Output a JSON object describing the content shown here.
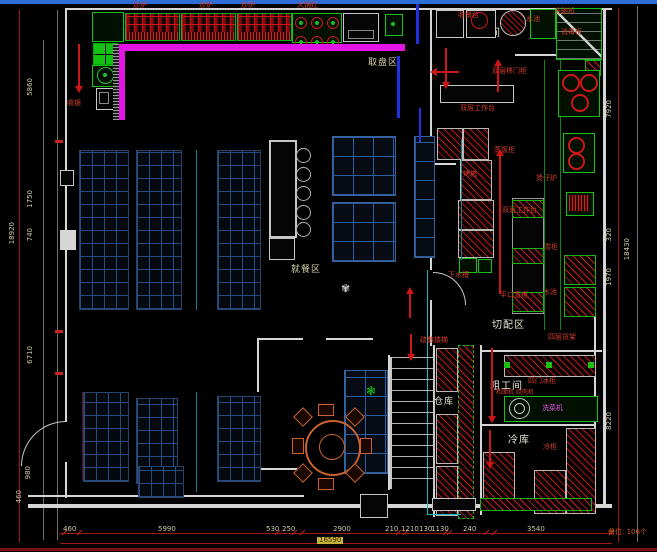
{
  "titlebar": {
    "color": "#2f6ed9"
  },
  "room_labels": {
    "dishwash": "洗碗间",
    "plate_area": "取盘区",
    "dining": "就餐区",
    "cutting": "切配区",
    "rough_work": "粗工间",
    "cold_storage": "冷库",
    "warehouse": "仓库"
  },
  "red_labels": {
    "cashier": "收银",
    "wok1": "炒炉",
    "wok2": "炒炉",
    "wok3": "炒炉",
    "big_wok": "大锅灶",
    "collect_table": "收餐台",
    "sink1": "水池",
    "dishwasher": "洗碗机",
    "disinfect_cabinet": "消毒柜",
    "sliding_cabinet": "双层移门柜",
    "worktable1": "双层工作台",
    "rice_steamer": "蒸饭柜",
    "oven": "烤箱",
    "claypot_stove": "煲仔炉",
    "worktable2": "双层工作台",
    "freezer_small": "雪柜",
    "sink2": "水池",
    "flat_freezer": "平口雪柜",
    "drain_sink": "下水槽",
    "shelf_4layer": "四层货架",
    "four_door_freezer": "四门冰柜",
    "stair_note": "疏散楼梯",
    "cold_cabinet": "冷柜",
    "prep_machines": "和面机 绞肉机"
  },
  "magenta_labels": {
    "veg_washer": "洗菜机"
  },
  "notes": {
    "seats": "餐位: 106个"
  },
  "dimensions": {
    "bottom": [
      "460",
      "5990",
      "530",
      "250",
      "2900",
      "210",
      "1210",
      "130",
      "1130",
      "240",
      "3540"
    ],
    "bottom_total": "16590",
    "left": [
      "5860",
      "1750",
      "740",
      "6710",
      "980",
      "460"
    ],
    "left_total": "18920",
    "right": [
      "7920",
      "320",
      "1970",
      "8220"
    ],
    "right_total": "18430"
  },
  "colors": {
    "accent_magenta": "#e414e4",
    "hatch_red": "#cc1a1a",
    "equipment_green": "#17c117",
    "booth_blue": "#2d5596"
  }
}
